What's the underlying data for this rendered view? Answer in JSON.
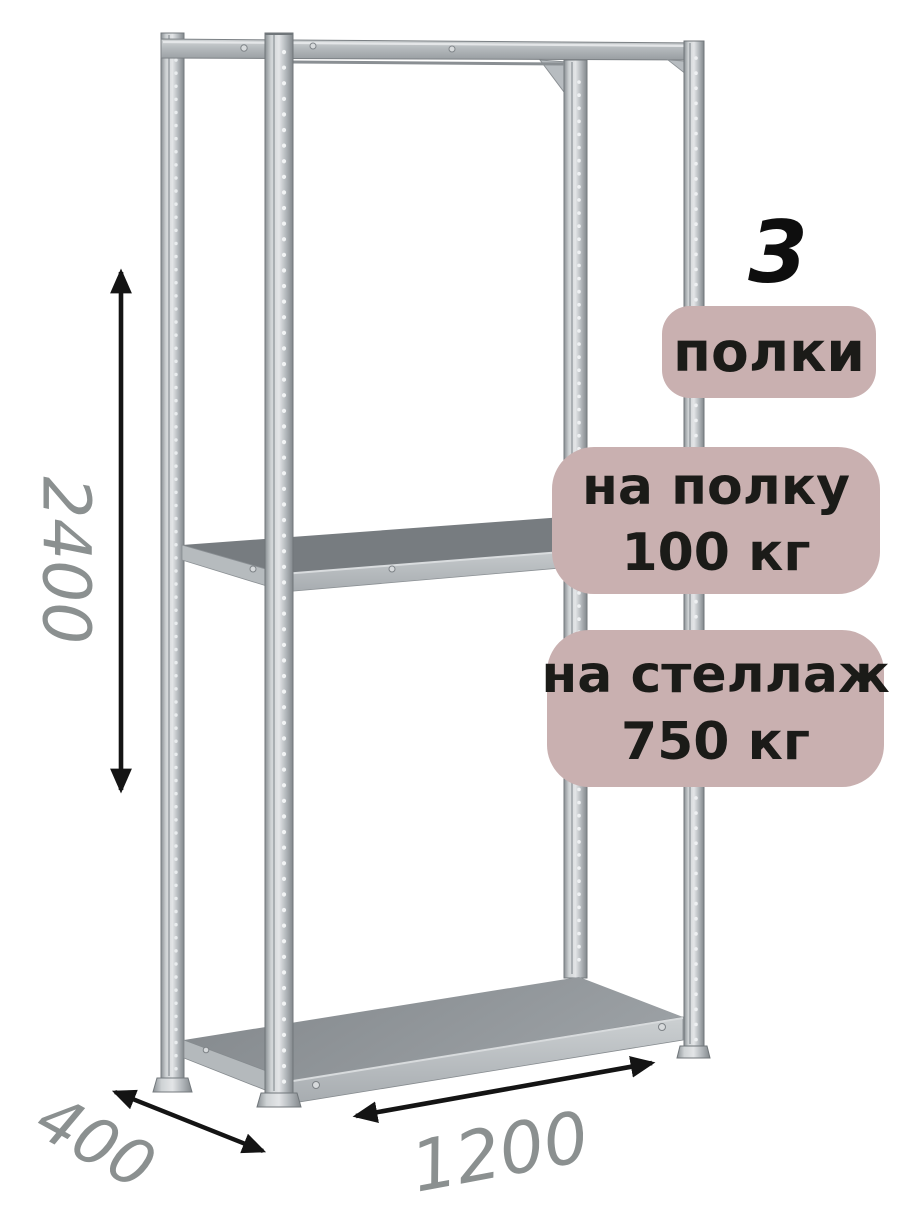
{
  "illustration": {
    "subject": "metal-shelving-rack",
    "shelves_visible": 3,
    "posts_visible": 4
  },
  "dimensions": {
    "height": "2400",
    "depth": "400",
    "width": "1200"
  },
  "badges": {
    "shelf_count": {
      "number": "3",
      "label": "полки"
    },
    "per_shelf_load": {
      "line1": "на полку",
      "line2": "100 кг"
    },
    "per_rack_load": {
      "line1": "на стеллаж",
      "line2": "750 кг"
    }
  },
  "colors": {
    "background": "#ffffff",
    "badge_bg": "#c9b0b0",
    "badge_text": "#1b1b18",
    "count_number_text": "#0e0e0e",
    "dimension_text": "#8b9090",
    "arrow": "#141414",
    "metal_light": "#e3e5e7",
    "metal_mid": "#b2b7bb",
    "metal_dark": "#82878b",
    "shelf_top_surface": "#777c80"
  }
}
